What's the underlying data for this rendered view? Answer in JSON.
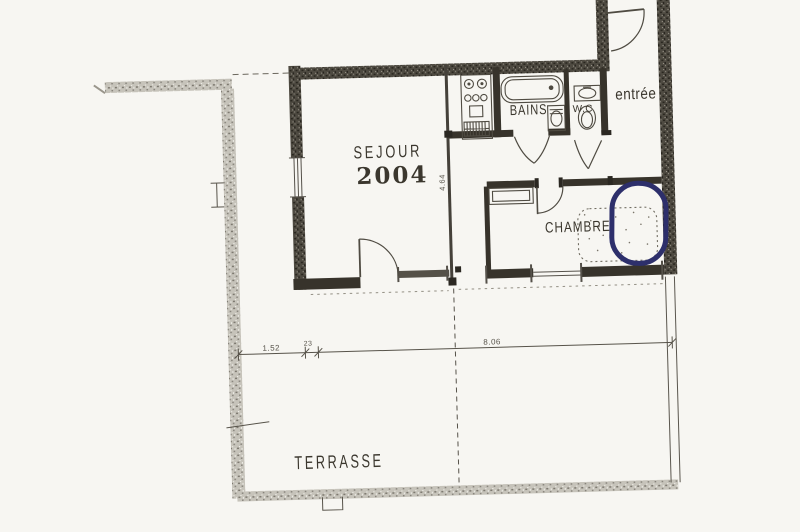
{
  "rooms": {
    "sejour": {
      "label": "SEJOUR",
      "number": "2004"
    },
    "bains": {
      "label": "BAINS"
    },
    "wc": {
      "label": "W.C"
    },
    "entree": {
      "label": "entrée"
    },
    "chambre": {
      "label": "CHAMBRE"
    },
    "terrasse": {
      "label": "TERRASSE"
    }
  },
  "dimensions": {
    "terrasse_left": "1.52",
    "terrasse_offset": "23",
    "terrasse_width": "8.06",
    "sejour_depth": "4.64"
  },
  "fixtures": [
    "kitchenette-icon",
    "bathtub-icon",
    "bidet-icon",
    "washbasin-icon",
    "toilet-icon",
    "wardrobe-icon",
    "bed-icon"
  ],
  "annotation": {
    "label": "blue-ink-oval",
    "color": "#2d2f6b"
  },
  "colors": {
    "paper": "#f7f6f2",
    "ink": "#3b372e",
    "wall_dark": "#4e4a41",
    "wall_light": "#c6c3ba",
    "dim": "#57534a"
  }
}
